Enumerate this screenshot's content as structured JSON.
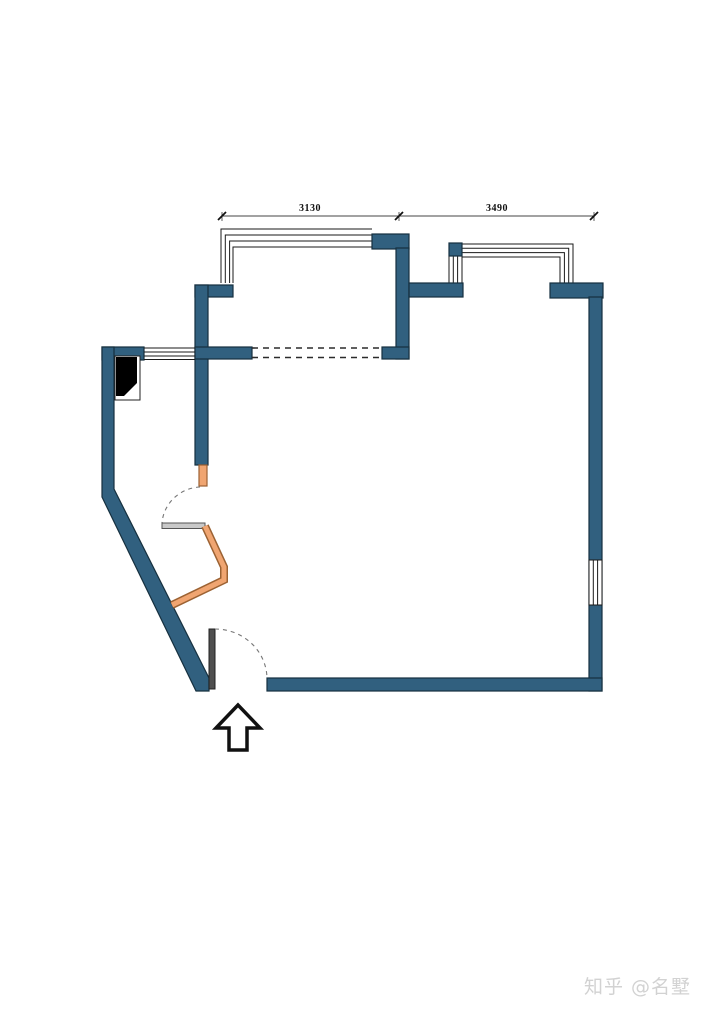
{
  "meta": {
    "type": "floor-plan"
  },
  "dimensions": {
    "top_left": {
      "label": "3130"
    },
    "top_right": {
      "label": "3490"
    }
  },
  "watermark": {
    "text": "知乎 @名墅",
    "color": "#d2d2d2"
  },
  "icons": {
    "entry_arrow": "up-arrow",
    "door_swings": "dashed-quarter-arc",
    "windows": "parallel-line-window-symbol",
    "duct_shaft": "black-filled-shaft-symbol"
  },
  "colors": {
    "wall_fill": "#31607f",
    "wall_stroke": "#16303f",
    "window_line": "#1a1a1a",
    "orange_fill": "#f0a571",
    "orange_stroke": "#9c6233",
    "door_leaf_gray": "#c9c9c9",
    "entry_leaf_dark": "#4f4f4f",
    "dashed_line": "#2b2b2b",
    "background": "#ffffff",
    "dim_text": "#111111",
    "watermark_color": "#d2d2d2"
  }
}
